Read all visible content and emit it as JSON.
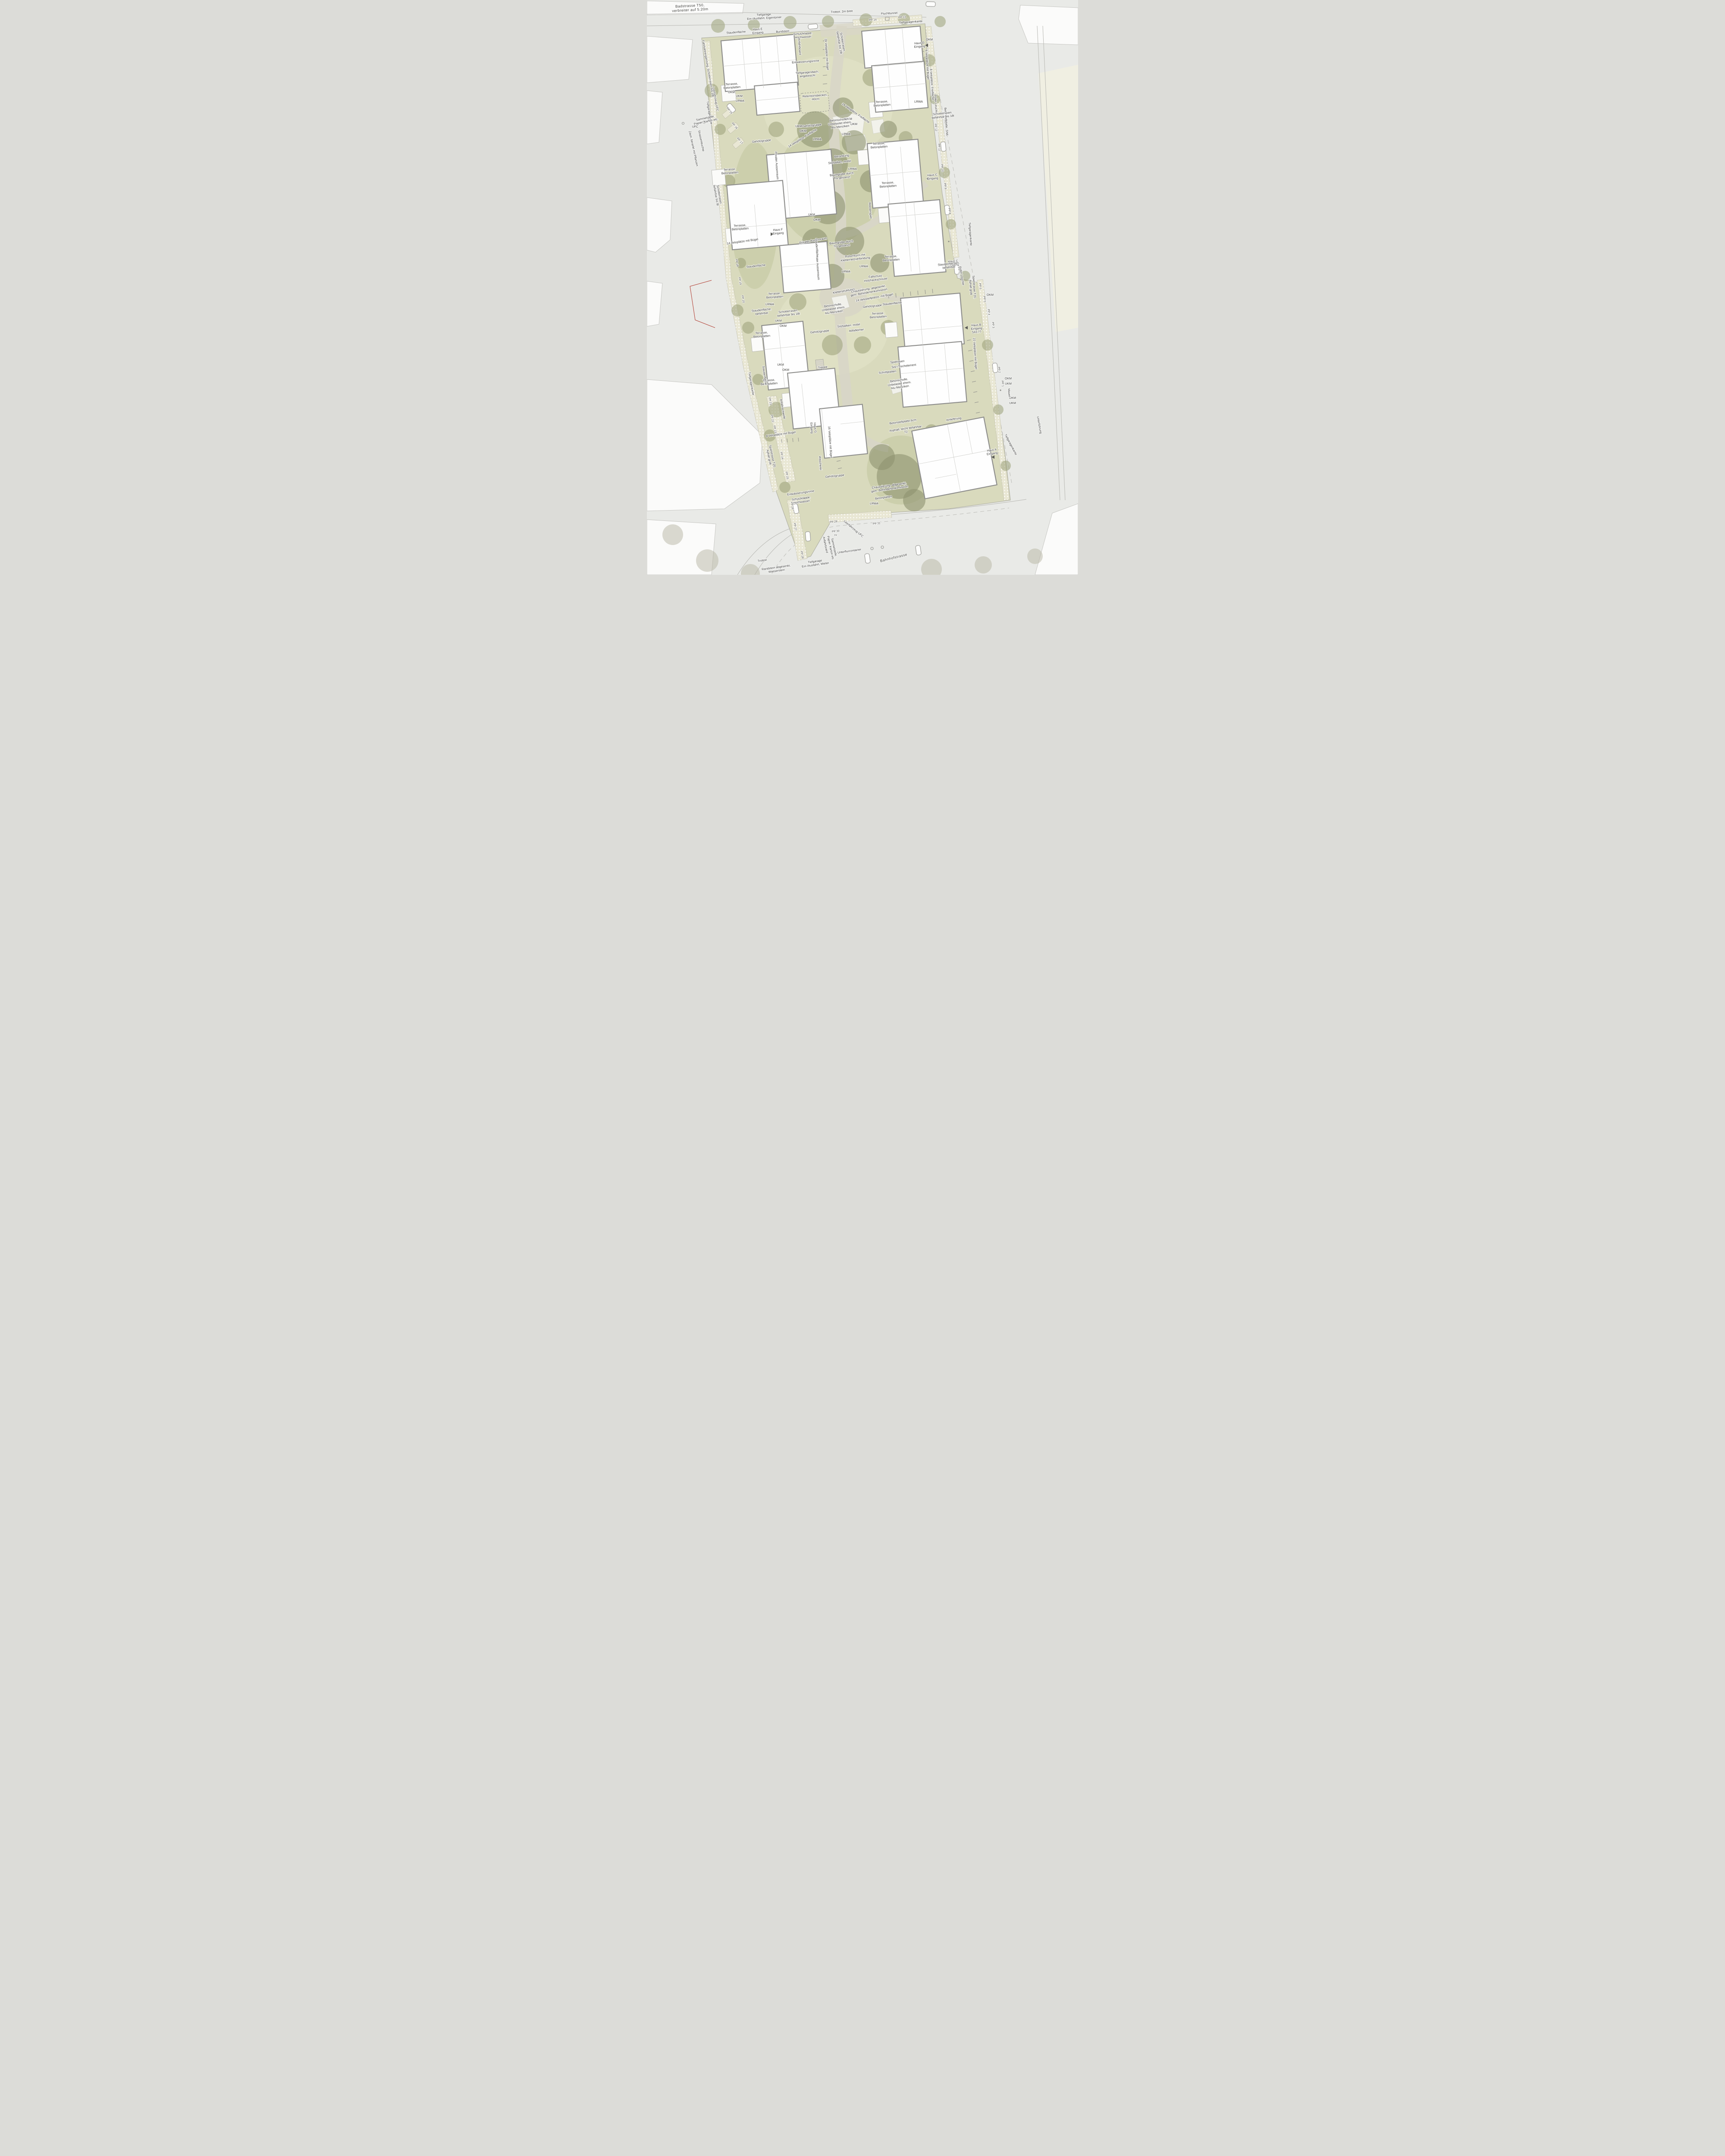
{
  "common": {
    "okm": "OKM",
    "ukm": "UKM",
    "lrwa": "LRWA",
    "terrasse": "Terrasse,\nBetonplatten",
    "gehoelzgruppe": "Gehölzgruppe",
    "staudenflaeche": "Staudenfläche",
    "poller": "Poller Leuchte",
    "tiefgaragenkante": "Tiefgaragenkante",
    "entwaesserungsrinne": "Entwässerungsrinne",
    "schutzklappe": "Schutzklappe,\nHochwasser",
    "anfahrboard": "Anfahrboard",
    "sammelstelle": "Sammelstelle,\nPapier, Karton etc.",
    "leerfahrzeug": "Leerfahrzeug UFC",
    "privater_aussenraum": "Privater Aussenraum",
    "schotterrasen_18t": "Schotterrasen,\nbefahrbar bis 18t",
    "sitzbalken": "Sitzbalken, mobil",
    "baumgrube": "Baumgrube durch\nTG gestanzt",
    "betonscholle": "Betonscholle,\nUnbelastet ehem.\nAlu Menziken",
    "chaussierung": "Chaussierung, abgesenkt,\ngem. Behindertenkomission",
    "spielstrasse": "Spielstrasse T20,\nAphalt grob"
  },
  "streets": {
    "badstrasse": "Badstrasse T50,\nverbreiter auf 5.20m",
    "trottoir_breit": "Trottoir, 2m breit",
    "bahnhofstrasse": "Bahnhofstrasse",
    "trottoir": "Trottoir",
    "unterfuehrung": "Unterführung",
    "mauer": "Mauer"
  },
  "houses": {
    "a": "Haus A\nEingang",
    "b": "Haus B\nEingang\n543.77",
    "c": "Haus C\nEingang",
    "d": "Haus D\nEingang",
    "e": "Haus E\nEingang",
    "f": "Haus F\nEingang",
    "g": "Haus G\nEingang"
  },
  "pp": {
    "p1": "PP 1",
    "p2": "PP 2",
    "p3": "PP 3",
    "p4": "PP 4",
    "p5": "PP 5",
    "p6": "PP 6",
    "p7": "PP 7",
    "p8": "PP 8",
    "p9": "PP 9",
    "p10": "PP 10",
    "p11": "PP 11",
    "p12": "PP 12",
    "p13": "PP 13",
    "p14": "PP 14",
    "p15": "PP 15",
    "p16": "PP 16",
    "p17": "PP 17",
    "p18": "PP 18",
    "p19": "PP 19",
    "p20": "PP 20",
    "p21": "PP 21",
    "p22": "PP 22",
    "p23": "PP 23",
    "p24": "PP 24",
    "p25": "PP 25",
    "p26": "PP 26",
    "p27": "PP 27",
    "p28": "PP 28",
    "p29": "PP 29",
    "p30": "PP 30",
    "p31": "PP 31",
    "iv": "IV"
  },
  "labels": {
    "fluchttunnel": "Fluchttunnel",
    "tiefgarage_eigentuemer": "Tiefgarage,\nEin-/Ausfahrt, Eigentümer",
    "tiefgarage_mieter": "Tiefgarage\nEin-/Ausfahrt, Mieter",
    "bundstein": "Bundstein",
    "tiefgaragendach": "Tiefgaragendach,\nangeböscht",
    "retentionsbecken": "Retentionsbecken,\n-40cm",
    "velo24": "24 Veloplätze mit Bügel",
    "velo6": "6 Veloplätze mit Bügel",
    "velo8_frei": "8 Veloplätze, Freifläche",
    "velo8_buegel": "8 Veloplätze mit Bügel",
    "velo14_buegel": "14 Veloplätze mit Bügel",
    "velo14_frei": "14 Veloplätze, Freifläche",
    "velostell14": "14 Velostellplätze, mit Bügel",
    "velo16": "16 Veloplätze mit Bügel",
    "velo22": "22 Veloplätze mit Bügel",
    "betonstellplatte_sn6": "Betonstellplatte, SN6",
    "betonstellplatte_6cm": "Betonstellplatte,6cm",
    "betonschollen": "Betonschollen,\nUnbelastet ehem.\nAlu Menziken",
    "berankung": "Berankung",
    "rutschturm": "Rutschturm mit\nKletternetzverbindung",
    "fallschutz": "Fallschutz\nHolzhackschnizel",
    "kletterstrukturen": "Kletterstrukturen",
    "wasserspiel": "Wasserspiel",
    "schotterrasen_8t": "Schotterrasen,\nbefahrbar bis 8t",
    "staudenflaeche_befahrbar": "Staudenfläche,\nbefahrbar",
    "staudenflaechen_befahrbar": "Staudenflächen,\nbefahrbar",
    "spielrasen": "Spielrasen",
    "sitz_tisch": "Sitz-/Tischelement",
    "schrittplatten": "Schrittplatten",
    "treppe": "Treppe",
    "waescherei": "Wäscherei",
    "anfahrschwelle": "Anfahrschwelle",
    "anlieferung": "Anlieferung",
    "asphalt_t2": "Asphalt, leicht befahrbar\nT2",
    "randstein": "Randstein abgesenkt,\nWasserstein",
    "unterflurcontainer": "Unterflurcontainer",
    "ufc": "UFC",
    "strassenleuchte": "Strassenleuchte",
    "zaun": "Zaun, berankt mit Pflanzen",
    "fahrbahnergaenzung": "Fahrbahnergänzung, Schotterrasen bis 18t.",
    "betonplatten": "Betonplatten"
  }
}
